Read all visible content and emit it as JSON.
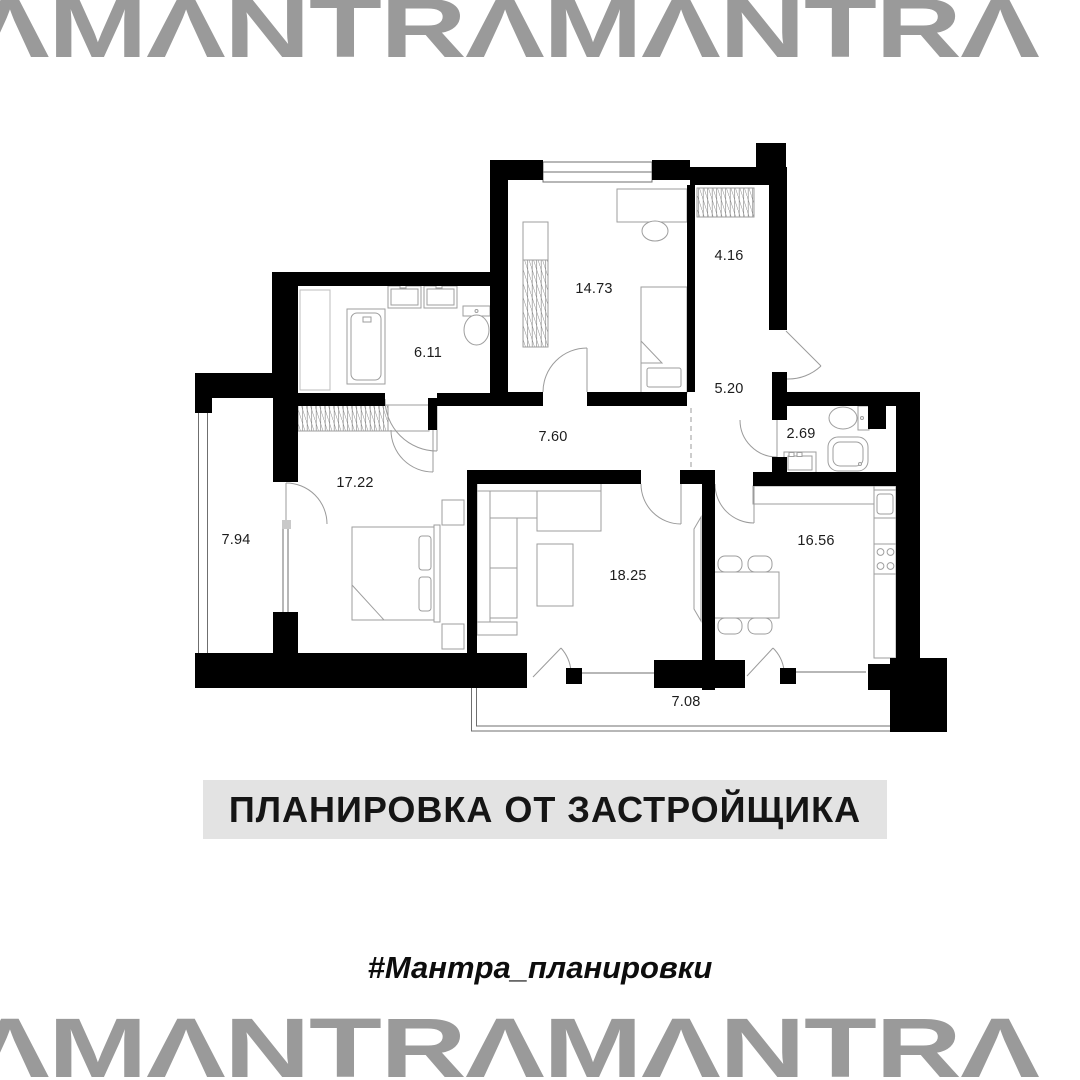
{
  "brand": {
    "logo_text": "AMANTRAMANTRA",
    "logo_display": "ΛMΛNTRΛMΛNTRΛ",
    "logo_color": "#9a9a9a"
  },
  "banner": {
    "label": "ПЛАНИРОВКА ОТ ЗАСТРОЙЩИКА",
    "bg_color": "#e3e3e3",
    "text_color": "#151515"
  },
  "hashtag": "#Мантра_планировки",
  "floor_plan": {
    "type": "apartment-floor-plan",
    "area_units": "m2",
    "wall_color": "#000000",
    "furniture_line_color": "#9e9e9e",
    "rooms": [
      {
        "name": "bedroom-top",
        "area": "14.73"
      },
      {
        "name": "closet",
        "area": "4.16"
      },
      {
        "name": "bathroom",
        "area": "6.11"
      },
      {
        "name": "hallway",
        "area": "5.20"
      },
      {
        "name": "corridor",
        "area": "7.60"
      },
      {
        "name": "shower-wc",
        "area": "2.69"
      },
      {
        "name": "bedroom-left",
        "area": "17.22"
      },
      {
        "name": "loggia-left",
        "area": "7.94"
      },
      {
        "name": "kitchen",
        "area": "16.56"
      },
      {
        "name": "living-room",
        "area": "18.25"
      },
      {
        "name": "loggia-bottom",
        "area": "7.08"
      }
    ]
  }
}
